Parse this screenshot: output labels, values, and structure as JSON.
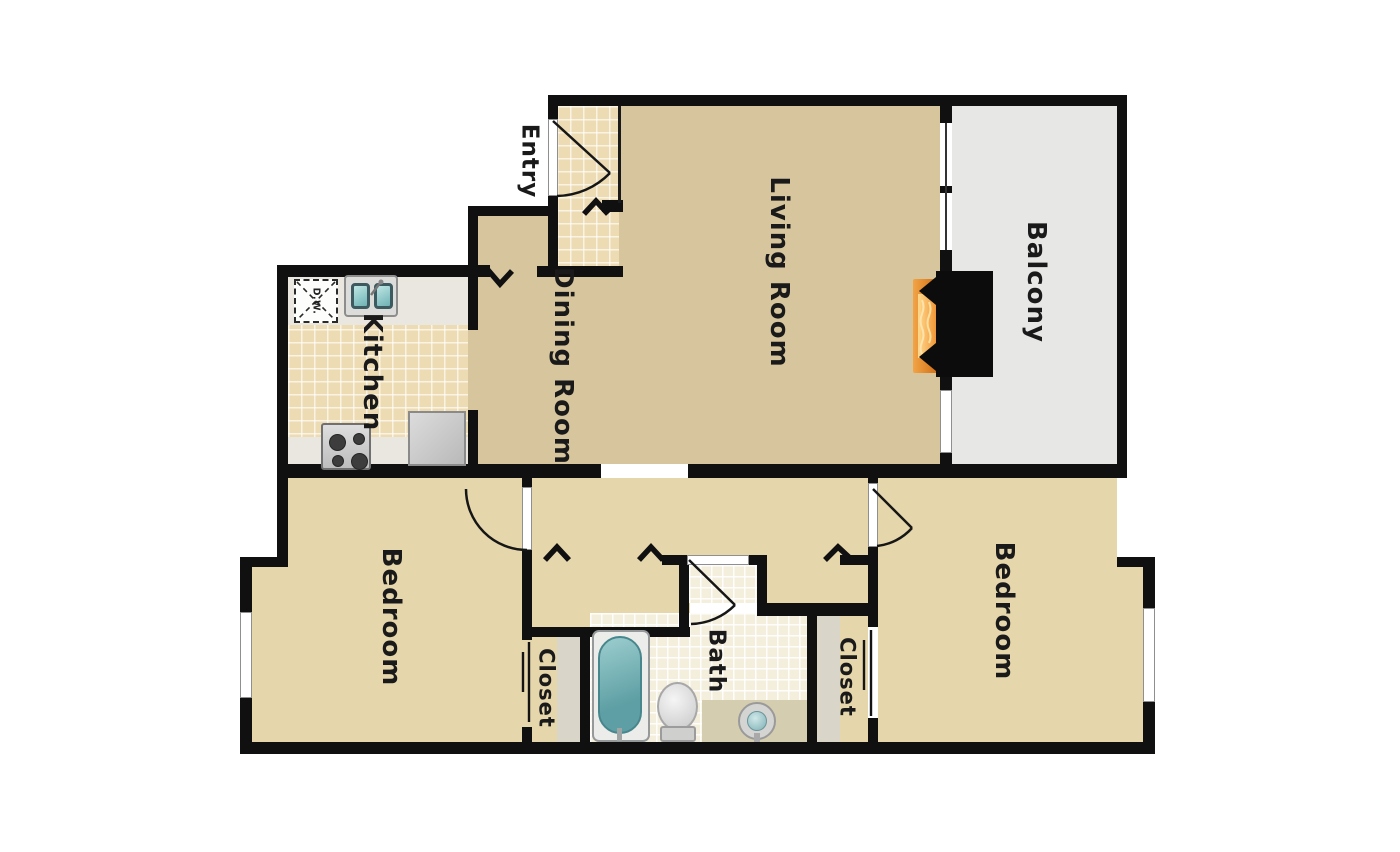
{
  "plan": {
    "type": "apartment-floor-plan",
    "rooms": [
      {
        "id": "entry",
        "label": "Entry"
      },
      {
        "id": "kitchen",
        "label": "Kitchen"
      },
      {
        "id": "dining-room",
        "label": "Dining Room"
      },
      {
        "id": "living-room",
        "label": "Living Room"
      },
      {
        "id": "balcony",
        "label": "Balcony"
      },
      {
        "id": "bedroom-left",
        "label": "Bedroom"
      },
      {
        "id": "closet-left",
        "label": "Closet"
      },
      {
        "id": "bath",
        "label": "Bath"
      },
      {
        "id": "closet-right",
        "label": "Closet"
      },
      {
        "id": "bedroom-right",
        "label": "Bedroom"
      }
    ],
    "fixtures": {
      "dishwasher_label": "D.W."
    },
    "colors": {
      "wall": "#101010",
      "floor_living_dining": "#d6c59d",
      "floor_bedrooms_hall": "#e5d6ab",
      "tile_kitchen_entry": "#eddcb3",
      "tile_bath": "#f4eedd",
      "balcony_floor": "#e7e7e6",
      "closet_shelf": "#d9d5c9",
      "counter": "#e9e7df",
      "tub_teal": "#6fb2b5",
      "fireplace_flame": "#e8872a"
    }
  }
}
